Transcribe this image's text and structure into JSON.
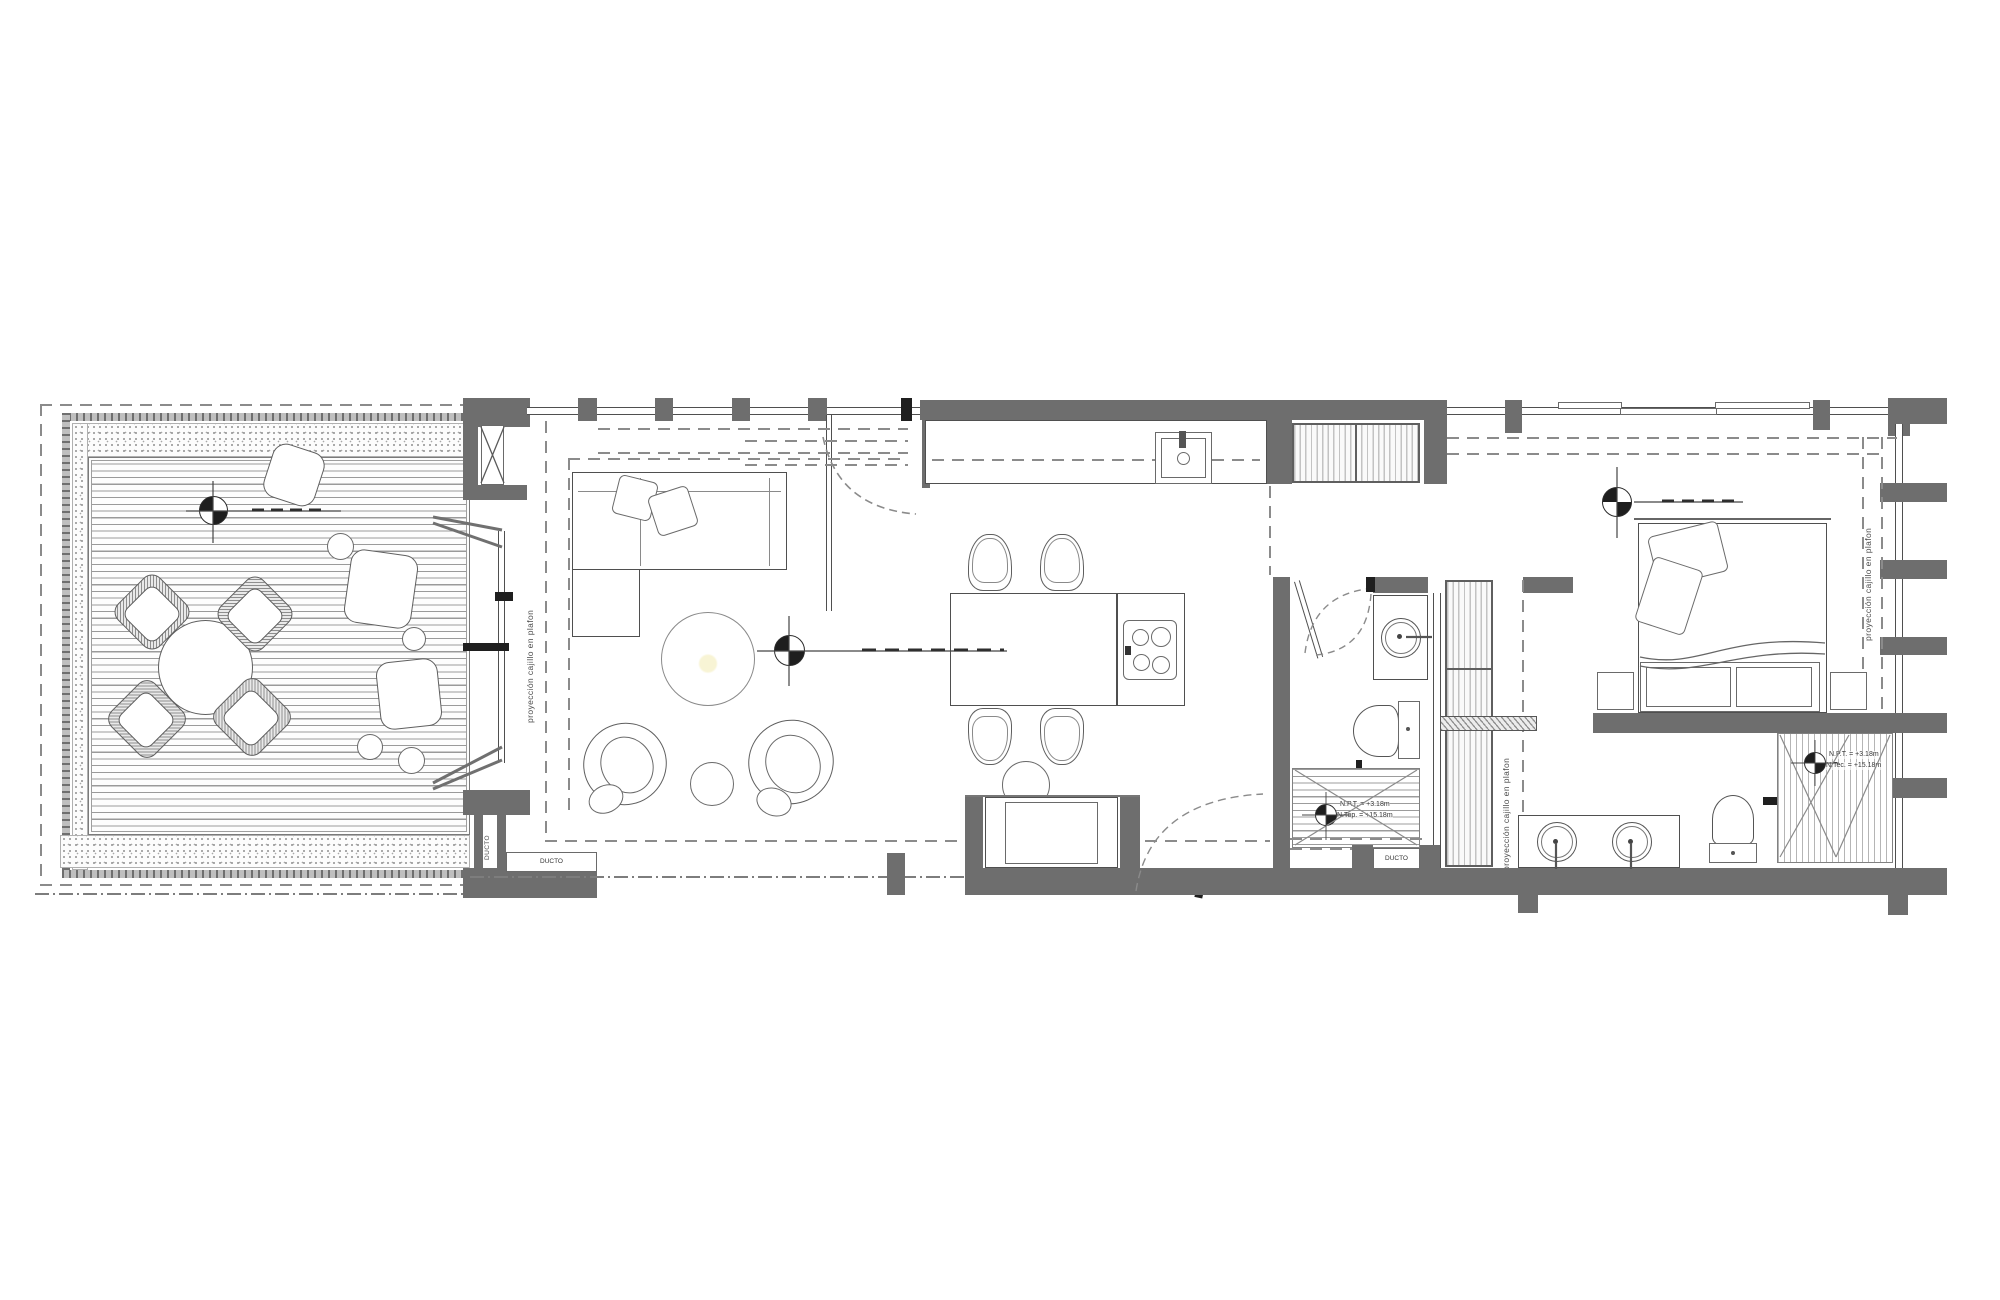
{
  "labels": {
    "ceiling_projection": "proyección cajillo en plafon",
    "duct": "DUCTO",
    "levels_wc": {
      "npt": "N.P.T. = +3.18m",
      "ntop": "N.Top. = +15.18m"
    },
    "levels_shower": {
      "npt": "N.P.T. = +3.18m",
      "ntec": "N.Tec. = +15.18m"
    }
  },
  "colors": {
    "paper": "#ffffff",
    "wall_fill": "#6e6e6e",
    "line": "#4f4f4f",
    "dark_accent": "#1f1f1f",
    "dash": "#8b8b8b",
    "hatch": "#9c9c9c"
  }
}
